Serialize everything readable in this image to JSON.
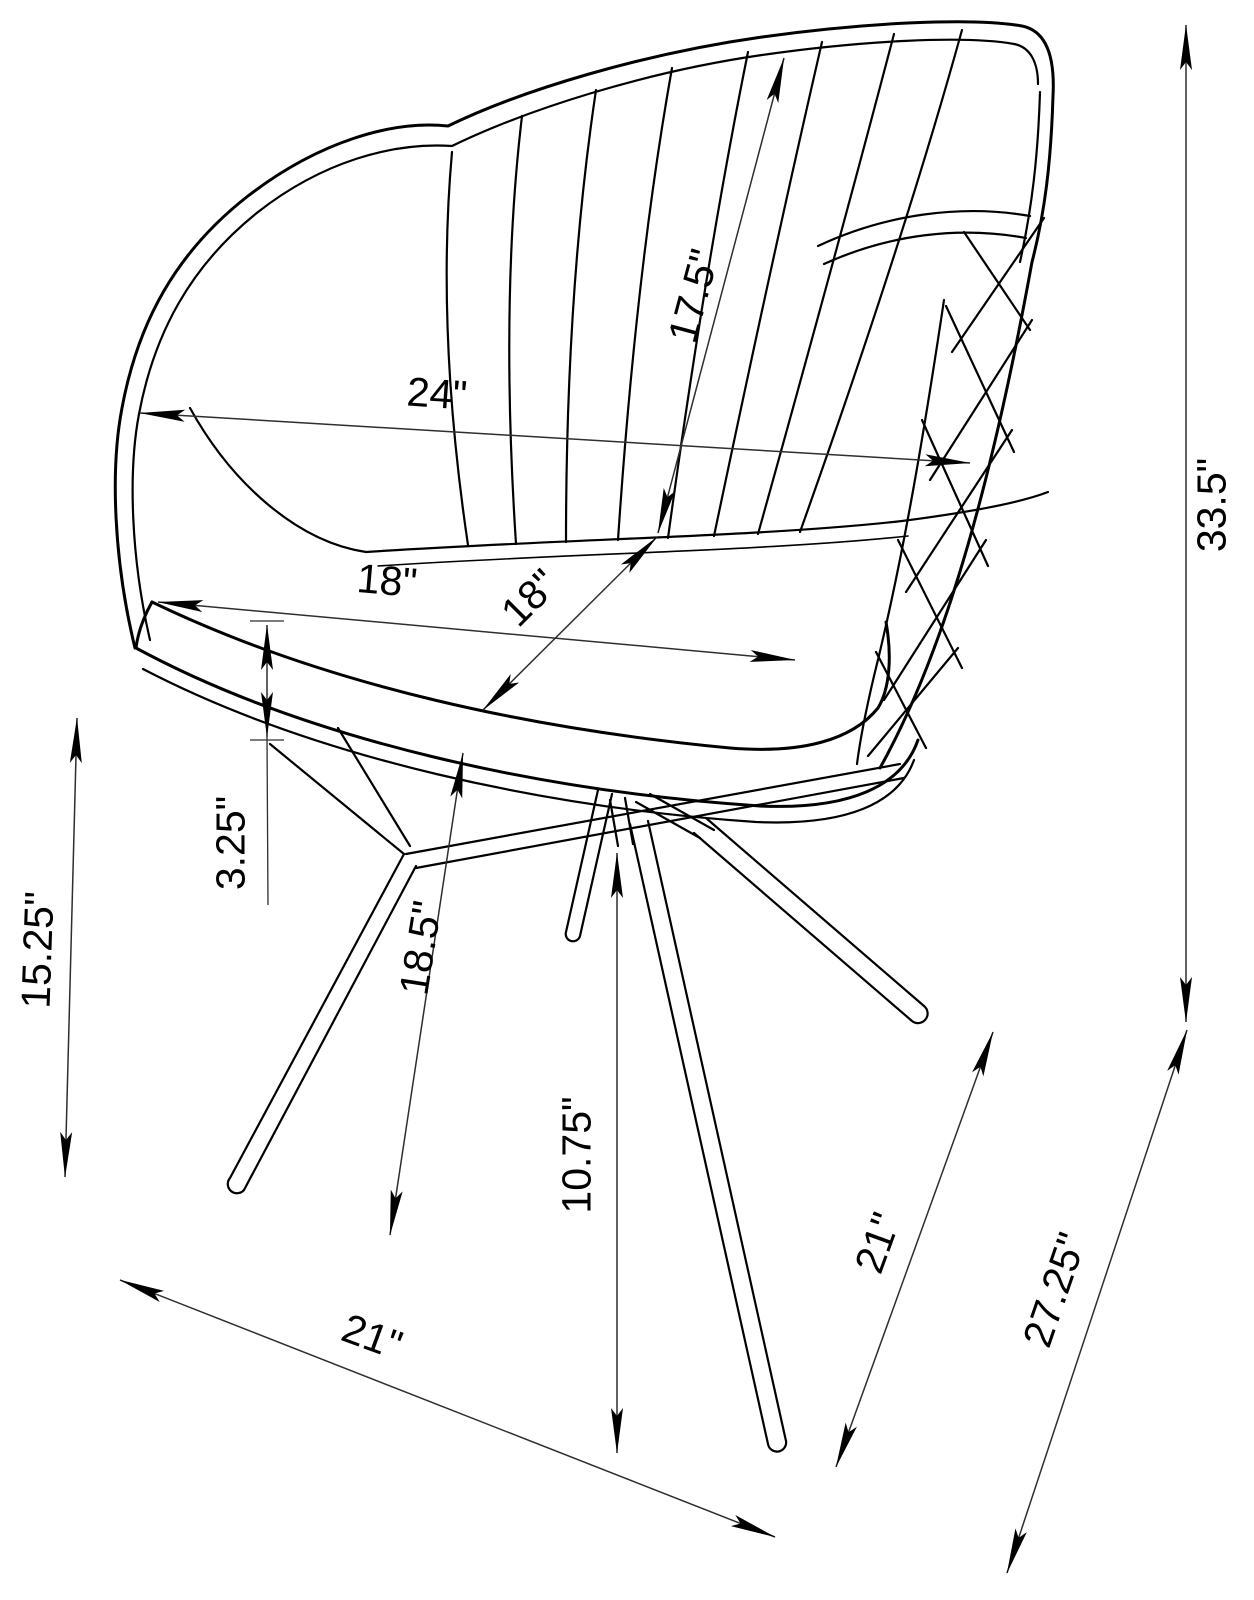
{
  "diagram": {
    "type": "furniture-dimension-drawing",
    "subject": "swivel dining armchair with channel-tufted back and 4-star metal base",
    "units": "inches",
    "colors": {
      "line": "#000000",
      "dim_line": "#2e2e2e",
      "background": "#ffffff"
    }
  },
  "dims": {
    "back_height": "17.5\"",
    "back_width": "24\"",
    "seat_width": "18\"",
    "seat_depth": "18\"",
    "overall_height": "33.5\"",
    "seat_thickness": "3.25\"",
    "seat_height": "15.25\"",
    "floor_to_seat": "18.5\"",
    "base_height": "10.75\"",
    "leg_span_right": "21\"",
    "base_diagonal": "27.25\"",
    "leg_span_front": "21\""
  }
}
